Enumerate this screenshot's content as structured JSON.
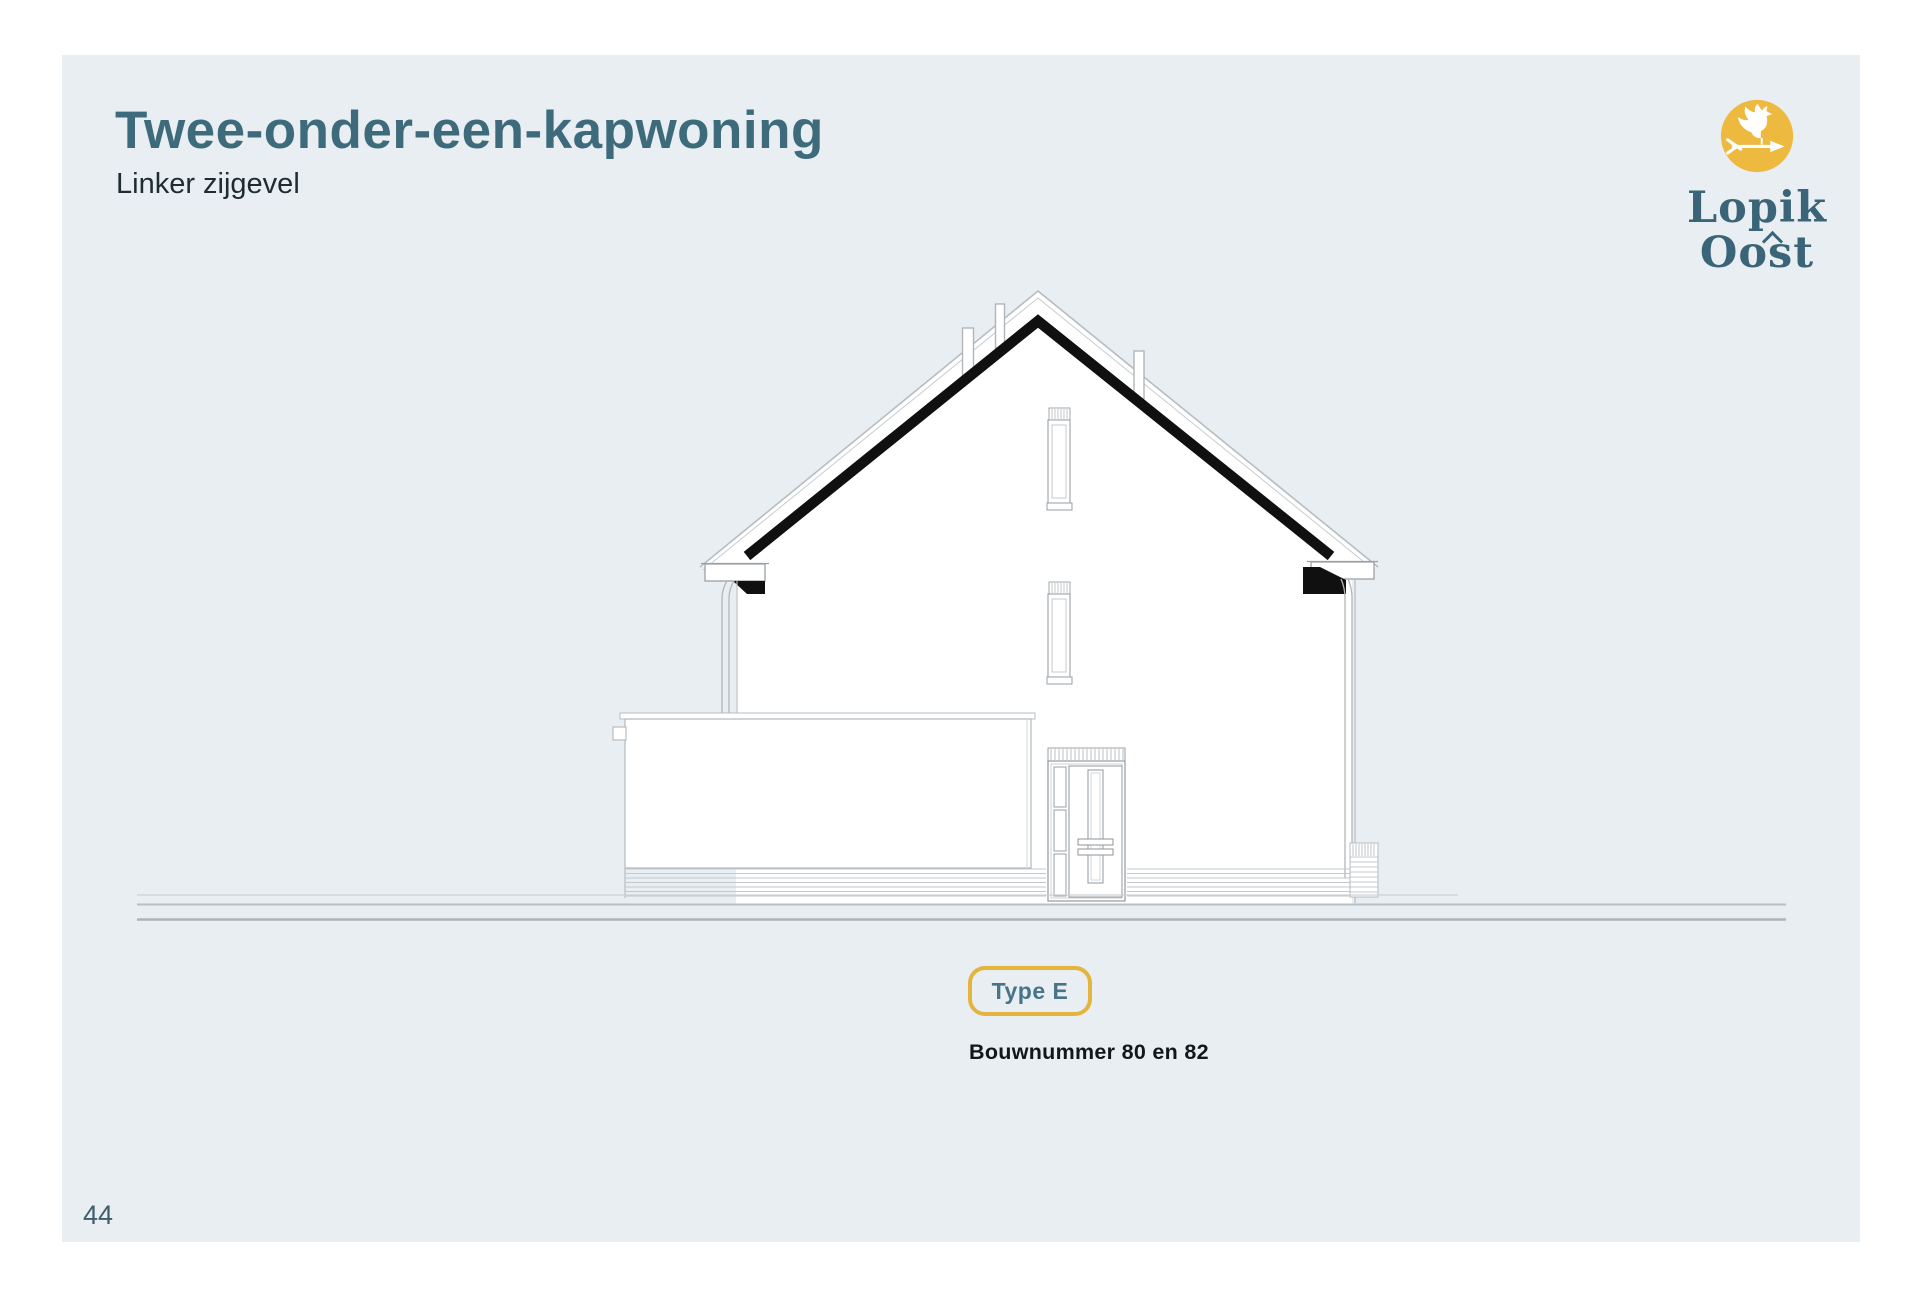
{
  "header": {
    "title": "Twee-onder-een-kapwoning",
    "subtitle": "Linker zijgevel"
  },
  "logo": {
    "icon": "rooster-weathervane-icon",
    "line1": "Lopik",
    "line2": "Oost"
  },
  "badge": {
    "label": "Type E"
  },
  "caption": {
    "text": "Bouwnummer 80 en 82"
  },
  "footer": {
    "page_number": "44"
  },
  "colors": {
    "accent_yellow": "#edb93f",
    "brand_teal": "#3e6b7c",
    "panel_background": "#e8eef1",
    "text_dark": "#1f2d33",
    "drawing_black": "#101010",
    "drawing_line": "#b6bcc0"
  }
}
